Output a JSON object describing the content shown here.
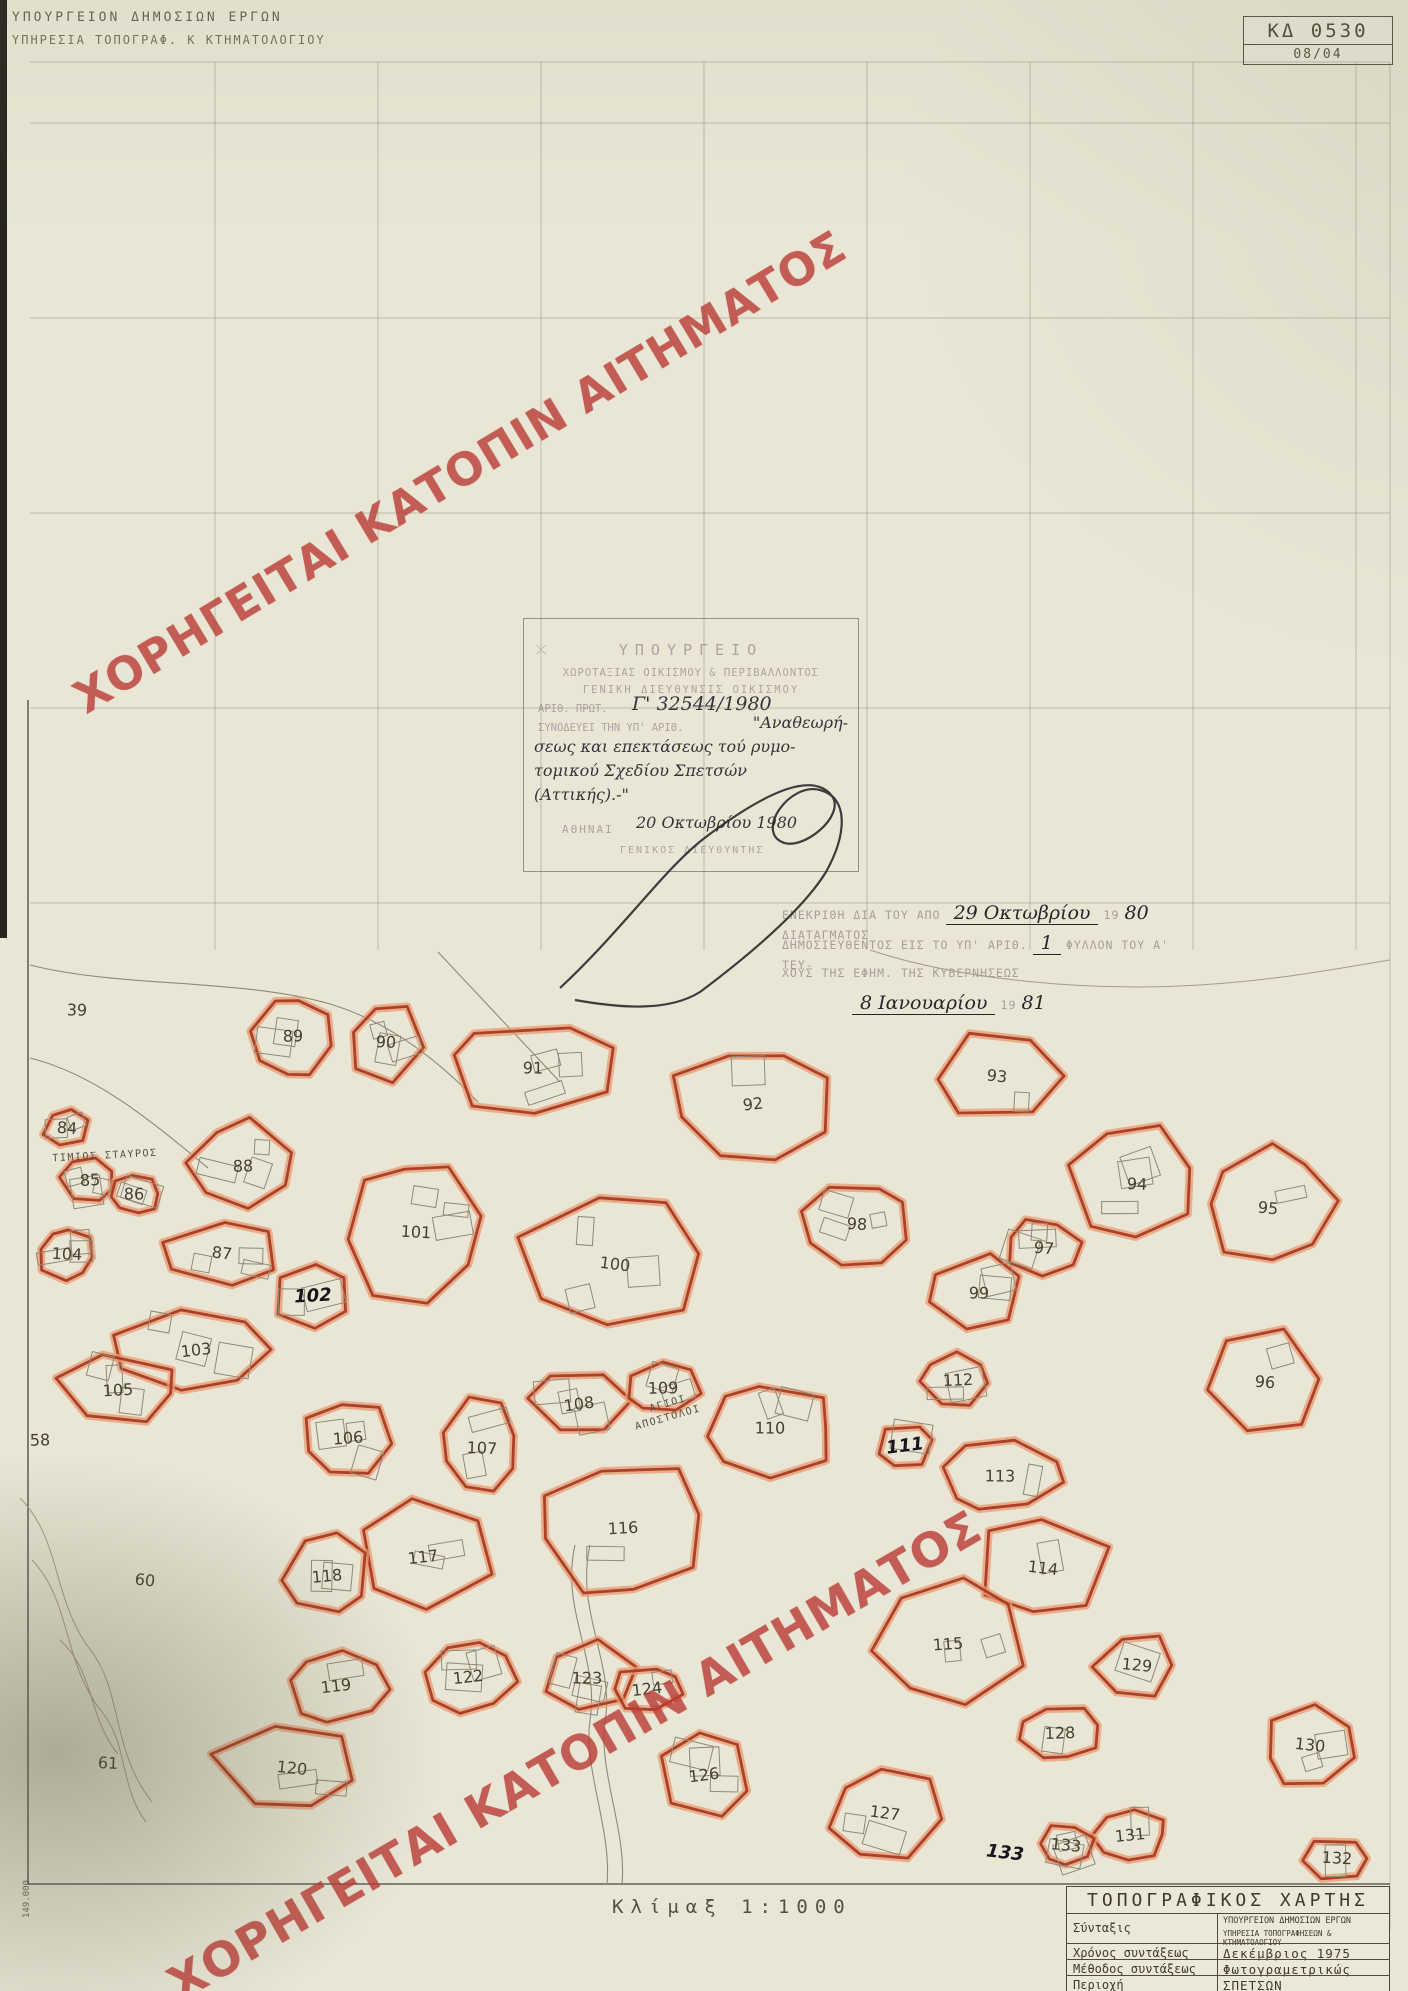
{
  "header": {
    "line1": "ΥΠΟΥΡΓΕΙΟΝ ΔΗΜΟΣΙΩΝ ΕΡΓΩΝ",
    "line2": "ΥΠΗΡΕΣΙΑ ΤΟΠΟΓΡΑΦ. Κ ΚΤΗΜΑΤΟΛΟΓΙΟΥ"
  },
  "sheet_code": {
    "code": "ΚΔ 0530",
    "index": "08/04"
  },
  "watermark": {
    "text": "ΧΟΡΗΓΕΙΤΑΙ ΚΑΤΟΠΙΝ ΑΙΤΗΜΑΤΟΣ",
    "color": "#ba3e37"
  },
  "stamp": {
    "line1": "ΥΠΟΥΡΓΕΙΟ",
    "line2": "ΧΩΡΟΤΑΞΙΑΣ ΟΙΚΙΣΜΟΥ & ΠΕΡΙΒΑΛΛΟΝΤΟΣ",
    "line3": "ΓΕΝΙΚΗ ΔΙΕΥΘΥΝΣΙΣ ΟΙΚΙΣΜΟΥ",
    "protocol_label": "ΑΡΙΘ. ΠΡΩΤ.",
    "protocol_hand": "Γ' 32544/1980",
    "line5_faint": "ΣΥΝΟΔΕΥΕΙ ΤΗΝ ΥΠ' ΑΡΙΘ.",
    "hand1": "\"Αναθεωρή-",
    "hand2": "σεως και επεκτάσεως τού ρυμο-",
    "hand3": "τομικού Σχεδίου Σπετσών",
    "hand4": "(Αττικής).-\"",
    "date_label": "ΑΘΗΝΑΙ",
    "date_hand": "20 Οκτωβρίου 1980",
    "sig_title": "ΓΕΝΙΚΟΣ ΔΙΕΥΘΥΝΤΗΣ"
  },
  "approval": {
    "pre1": "ΕΝΕΚΡΙΘΗ ΔΙΑ ΤΟΥ ΑΠΟ",
    "hand1": "29 Οκτωβρίου",
    "mid1": "19",
    "hand1b": "80",
    "post1": "ΔΙΑΤΑΓΜΑΤΟΣ",
    "pre2": "ΔΗΜΟΣΙΕΥΘΕΝΤΟΣ ΕΙΣ ΤΟ ΥΠ' ΑΡΙΘ.",
    "hand2": "1",
    "post2": "ΦΥΛΛΟΝ ΤΟΥ Α' ΤΕΥ-",
    "line3": "ΧΟΥΣ ΤΗΣ ΕΦΗΜ. ΤΗΣ ΚΥΒΕΡΝΗΣΕΩΣ",
    "hand4": "8 Ιανουαρίου",
    "mid4": "19",
    "hand4b": "81"
  },
  "scale_label": "Κλίμαξ  1:1000",
  "margin_note": "149.000",
  "title_block": {
    "title": "ΤΟΠΟΓΡΑΦΙΚΟΣ  ΧΑΡΤΗΣ",
    "syntaxis_label": "Σύνταξις",
    "syntaxis_value1": "ΥΠΟΥΡΓΕΙΟΝ ΔΗΜΟΣΙΩΝ ΕΡΓΩΝ",
    "syntaxis_value2": "ΥΠΗΡΕΣΙΑ ΤΟΠΟΓΡΑΦΗΣΕΩΝ & ΚΤΗΜΑΤΟΛΟΓΙΟΥ",
    "rows": [
      {
        "label": "Χρόνος συντάξεως",
        "value": "Δεκέμβριος  1975"
      },
      {
        "label": "Μέθοδος συντάξεως",
        "value": "Φωτογραμετρικώς"
      },
      {
        "label": "Περιοχή",
        "value": "ΣΠΕΤΣΩΝ"
      },
      {
        "label": "ΝΟΜΟΣ",
        "value": "ΠΕΙΡΑΙΩΣ"
      }
    ]
  },
  "map": {
    "accent": "#a93a24",
    "halo": "#e79b72",
    "blocks": [
      {
        "num": 39,
        "x": 77,
        "y": 1010,
        "w": 0,
        "h": 0,
        "outlined": false,
        "hand": false
      },
      {
        "num": 58,
        "x": 40,
        "y": 1440,
        "w": 0,
        "h": 0,
        "outlined": false,
        "hand": false
      },
      {
        "num": 60,
        "x": 145,
        "y": 1580,
        "w": 0,
        "h": 0,
        "outlined": false,
        "hand": false
      },
      {
        "num": 61,
        "x": 108,
        "y": 1763,
        "w": 0,
        "h": 0,
        "outlined": false,
        "hand": false
      },
      {
        "num": 84,
        "x": 67,
        "y": 1128,
        "w": 54,
        "h": 44,
        "outlined": true,
        "hand": false
      },
      {
        "num": 85,
        "x": 90,
        "y": 1180,
        "w": 66,
        "h": 54,
        "outlined": true,
        "hand": false
      },
      {
        "num": 86,
        "x": 134,
        "y": 1194,
        "w": 58,
        "h": 50,
        "outlined": true,
        "hand": false
      },
      {
        "num": 87,
        "x": 222,
        "y": 1253,
        "w": 150,
        "h": 76,
        "outlined": true,
        "hand": false
      },
      {
        "num": 88,
        "x": 243,
        "y": 1166,
        "w": 120,
        "h": 104,
        "outlined": true,
        "hand": false
      },
      {
        "num": 89,
        "x": 293,
        "y": 1036,
        "w": 92,
        "h": 96,
        "outlined": true,
        "hand": false
      },
      {
        "num": 90,
        "x": 386,
        "y": 1042,
        "w": 92,
        "h": 96,
        "outlined": true,
        "hand": false
      },
      {
        "num": 91,
        "x": 533,
        "y": 1068,
        "w": 208,
        "h": 112,
        "outlined": true,
        "hand": false
      },
      {
        "num": 92,
        "x": 753,
        "y": 1104,
        "w": 192,
        "h": 140,
        "outlined": true,
        "hand": false
      },
      {
        "num": 93,
        "x": 997,
        "y": 1076,
        "w": 160,
        "h": 108,
        "outlined": true,
        "hand": false
      },
      {
        "num": 94,
        "x": 1137,
        "y": 1184,
        "w": 150,
        "h": 128,
        "outlined": true,
        "hand": false
      },
      {
        "num": 95,
        "x": 1268,
        "y": 1208,
        "w": 156,
        "h": 136,
        "outlined": true,
        "hand": false
      },
      {
        "num": 96,
        "x": 1265,
        "y": 1382,
        "w": 148,
        "h": 120,
        "outlined": true,
        "hand": false
      },
      {
        "num": 97,
        "x": 1044,
        "y": 1248,
        "w": 90,
        "h": 68,
        "outlined": true,
        "hand": false
      },
      {
        "num": 98,
        "x": 857,
        "y": 1224,
        "w": 122,
        "h": 108,
        "outlined": true,
        "hand": false
      },
      {
        "num": 99,
        "x": 979,
        "y": 1293,
        "w": 118,
        "h": 88,
        "outlined": true,
        "hand": false
      },
      {
        "num": 100,
        "x": 615,
        "y": 1264,
        "w": 232,
        "h": 162,
        "outlined": true,
        "hand": false
      },
      {
        "num": 101,
        "x": 416,
        "y": 1232,
        "w": 152,
        "h": 168,
        "outlined": true,
        "hand": false
      },
      {
        "num": 102,
        "x": 313,
        "y": 1296,
        "w": 92,
        "h": 78,
        "outlined": true,
        "hand": true
      },
      {
        "num": 103,
        "x": 196,
        "y": 1350,
        "w": 196,
        "h": 88,
        "outlined": true,
        "hand": false
      },
      {
        "num": 104,
        "x": 67,
        "y": 1254,
        "w": 70,
        "h": 58,
        "outlined": true,
        "hand": false
      },
      {
        "num": 105,
        "x": 118,
        "y": 1390,
        "w": 148,
        "h": 78,
        "outlined": true,
        "hand": false
      },
      {
        "num": 106,
        "x": 348,
        "y": 1438,
        "w": 112,
        "h": 88,
        "outlined": true,
        "hand": false
      },
      {
        "num": 107,
        "x": 482,
        "y": 1448,
        "w": 88,
        "h": 116,
        "outlined": true,
        "hand": false
      },
      {
        "num": 108,
        "x": 579,
        "y": 1404,
        "w": 112,
        "h": 78,
        "outlined": true,
        "hand": false
      },
      {
        "num": 109,
        "x": 663,
        "y": 1388,
        "w": 82,
        "h": 58,
        "outlined": true,
        "hand": false
      },
      {
        "num": 110,
        "x": 770,
        "y": 1428,
        "w": 150,
        "h": 118,
        "outlined": true,
        "hand": false
      },
      {
        "num": 111,
        "x": 905,
        "y": 1446,
        "w": 70,
        "h": 56,
        "outlined": true,
        "hand": true
      },
      {
        "num": 112,
        "x": 958,
        "y": 1380,
        "w": 80,
        "h": 60,
        "outlined": true,
        "hand": false
      },
      {
        "num": 113,
        "x": 1000,
        "y": 1476,
        "w": 138,
        "h": 86,
        "outlined": true,
        "hand": false
      },
      {
        "num": 114,
        "x": 1043,
        "y": 1568,
        "w": 166,
        "h": 116,
        "outlined": true,
        "hand": false
      },
      {
        "num": 115,
        "x": 948,
        "y": 1644,
        "w": 196,
        "h": 146,
        "outlined": true,
        "hand": false
      },
      {
        "num": 116,
        "x": 623,
        "y": 1528,
        "w": 218,
        "h": 166,
        "outlined": true,
        "hand": false
      },
      {
        "num": 117,
        "x": 423,
        "y": 1557,
        "w": 158,
        "h": 138,
        "outlined": true,
        "hand": false
      },
      {
        "num": 118,
        "x": 327,
        "y": 1576,
        "w": 108,
        "h": 96,
        "outlined": true,
        "hand": false
      },
      {
        "num": 119,
        "x": 336,
        "y": 1686,
        "w": 118,
        "h": 86,
        "outlined": true,
        "hand": false
      },
      {
        "num": 120,
        "x": 292,
        "y": 1768,
        "w": 176,
        "h": 106,
        "outlined": true,
        "hand": false
      },
      {
        "num": 122,
        "x": 468,
        "y": 1677,
        "w": 106,
        "h": 78,
        "outlined": true,
        "hand": false
      },
      {
        "num": 123,
        "x": 587,
        "y": 1678,
        "w": 108,
        "h": 86,
        "outlined": true,
        "hand": false
      },
      {
        "num": 124,
        "x": 647,
        "y": 1689,
        "w": 78,
        "h": 58,
        "outlined": true,
        "hand": false
      },
      {
        "num": 126,
        "x": 704,
        "y": 1775,
        "w": 118,
        "h": 96,
        "outlined": true,
        "hand": false
      },
      {
        "num": 127,
        "x": 885,
        "y": 1813,
        "w": 146,
        "h": 104,
        "outlined": true,
        "hand": false
      },
      {
        "num": 128,
        "x": 1060,
        "y": 1733,
        "w": 88,
        "h": 66,
        "outlined": true,
        "hand": false
      },
      {
        "num": 129,
        "x": 1137,
        "y": 1665,
        "w": 98,
        "h": 76,
        "outlined": true,
        "hand": false
      },
      {
        "num": 130,
        "x": 1310,
        "y": 1745,
        "w": 116,
        "h": 96,
        "outlined": true,
        "hand": false
      },
      {
        "num": 131,
        "x": 1130,
        "y": 1835,
        "w": 88,
        "h": 64,
        "outlined": true,
        "hand": false
      },
      {
        "num": 132,
        "x": 1337,
        "y": 1858,
        "w": 76,
        "h": 48,
        "outlined": true,
        "hand": false
      },
      {
        "num": 133,
        "x": 1005,
        "y": 1853,
        "w": 0,
        "h": 0,
        "outlined": false,
        "hand": true
      },
      {
        "num": 133,
        "x": 1066,
        "y": 1845,
        "w": 68,
        "h": 48,
        "outlined": true,
        "hand": false
      }
    ],
    "labels": [
      {
        "text": "ΤΙΜΙΟΣ ΣΤΑΥΡΟΣ",
        "x": 105,
        "y": 1156,
        "rot": -3
      },
      {
        "text": "ΑΓΙΟΙ",
        "x": 668,
        "y": 1404,
        "rot": -16
      },
      {
        "text": "ΑΠΟΣΤΟΛΟΙ",
        "x": 668,
        "y": 1418,
        "rot": -16
      }
    ]
  }
}
